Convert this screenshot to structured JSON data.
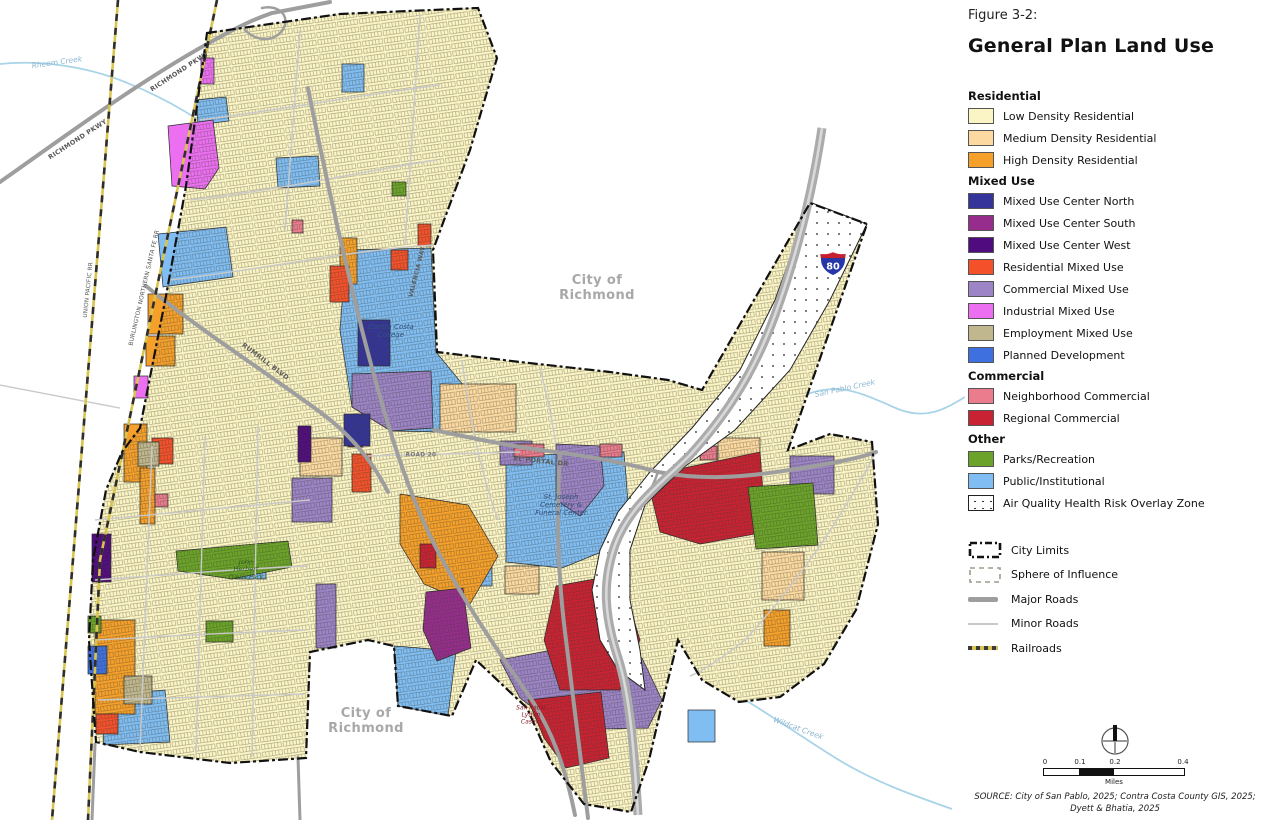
{
  "figure": {
    "label": "Figure 3-2:",
    "title": "General Plan Land Use"
  },
  "palette": {
    "low_density": "#FBF4C4",
    "medium_density": "#FBD9A1",
    "high_density": "#F5A02B",
    "mu_center_north": "#34349A",
    "mu_center_south": "#962D8D",
    "mu_center_west": "#500C7E",
    "residential_mu": "#F4512B",
    "commercial_mu": "#9C84C6",
    "industrial_mu": "#EC6FF2",
    "employment_mu": "#C0B78E",
    "planned_development": "#3E70E0",
    "neighborhood_commercial": "#EA7C8D",
    "regional_commercial": "#C92233",
    "parks": "#6BA32A",
    "public": "#80BDF2",
    "road_major": "#9E9E9E",
    "road_minor": "#C9C9C9",
    "freeway": "#ABABAB",
    "creek": "#A9D4E8",
    "rail_yellow": "#D9C44F",
    "shield_red": "#C6202E",
    "shield_blue": "#2637A8"
  },
  "legend": {
    "sections": [
      {
        "header": "Residential",
        "items": [
          {
            "label": "Low Density Residential"
          },
          {
            "label": "Medium Density Residential"
          },
          {
            "label": "High Density Residential"
          }
        ]
      },
      {
        "header": "Mixed Use",
        "items": [
          {
            "label": "Mixed Use Center North"
          },
          {
            "label": "Mixed Use Center South"
          },
          {
            "label": "Mixed Use Center West"
          },
          {
            "label": "Residential Mixed Use"
          },
          {
            "label": "Commercial Mixed Use"
          },
          {
            "label": "Industrial Mixed Use"
          },
          {
            "label": "Employment Mixed Use"
          },
          {
            "label": "Planned Development"
          }
        ]
      },
      {
        "header": "Commercial",
        "items": [
          {
            "label": "Neighborhood Commercial"
          },
          {
            "label": "Regional Commercial"
          }
        ]
      },
      {
        "header": "Other",
        "items": [
          {
            "label": "Parks/Recreation"
          },
          {
            "label": "Public/Institutional"
          }
        ]
      }
    ],
    "overlay": {
      "label": "Air Quality Health Risk Overlay Zone"
    },
    "lines": [
      {
        "label": "City Limits"
      },
      {
        "label": "Sphere of Influence"
      },
      {
        "label": "Major Roads"
      },
      {
        "label": "Minor Roads"
      },
      {
        "label": "Railroads"
      }
    ]
  },
  "map": {
    "labels": {
      "city_richmond_north": "City of\nRichmond",
      "city_richmond_south": "City of\nRichmond",
      "rheem_creek": "Rheem Creek",
      "san_pablo_creek": "San Pablo Creek",
      "wildcat_creek": "Wildcat Creek",
      "richmond_pkwy_upper": "RICHMOND PKWY",
      "richmond_pkwy_lower": "RICHMOND PKWY",
      "union_pacific": "UNION PACIFIC RR",
      "bnsf": "BURLINGTON NORTHERN SANTA FE RR",
      "valencia_way": "VALENCIA WAY",
      "rumrill_blvd": "RUMRILL BLVD",
      "el_portal_dr": "EL PORTAL DR",
      "road_20": "ROAD 20",
      "contra_costa_college": "Contra Costa\nCollege",
      "st_joseph": "St. Joseph\nCemetery &\nFuneral Center",
      "davis_park": "John\nHerbert\nDavis Park",
      "lytton_casino": "San Pablo\nLytton\nCasino",
      "i80": "80"
    }
  },
  "scale_bar": {
    "ticks": [
      "0",
      "0.1",
      "0.2",
      "0.4"
    ],
    "unit": "Miles"
  },
  "source": "SOURCE: City of San Pablo, 2025; Contra Costa County GIS, 2025;\nDyett & Bhatia, 2025"
}
